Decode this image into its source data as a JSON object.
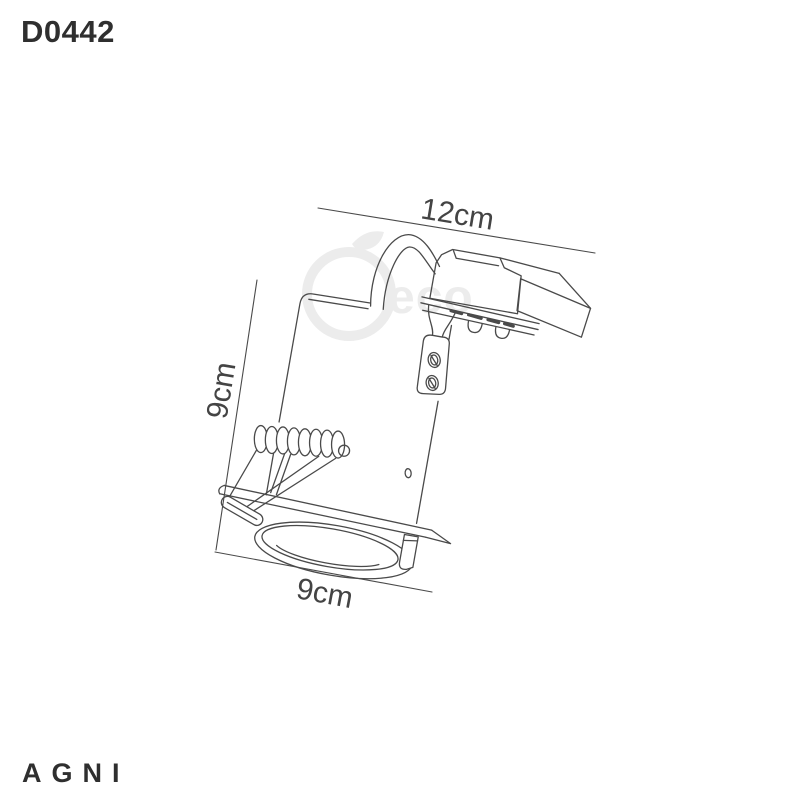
{
  "product": {
    "code": "D0442",
    "brand": "AGNI"
  },
  "dimensions": {
    "width_top": "12cm",
    "height_left": "9cm",
    "width_bottom": "9cm"
  },
  "watermark": {
    "text": "eco"
  },
  "drawing": {
    "subject": "recessed-downlight-fixture"
  },
  "colors": {
    "line": "#4a4a4a",
    "text": "#2f2f2f",
    "dimension_text": "#444444",
    "watermark": "#ececec",
    "background": "#ffffff"
  }
}
